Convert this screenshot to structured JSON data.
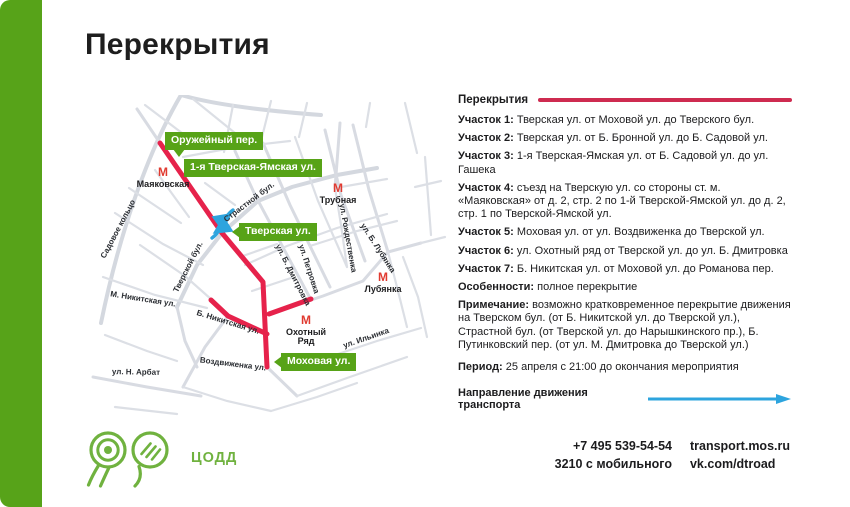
{
  "title": "Перекрытия",
  "colors": {
    "accent_green": "#57a319",
    "label_green": "#57a317",
    "closure_red": "#e6224b",
    "rule_red": "#ce2b50",
    "direction_blue": "#2da4de",
    "metro_red": "#e03a30",
    "logo_green": "#70b23f"
  },
  "map": {
    "metro_symbol": "М",
    "closure_labels": [
      "Оружейный пер.",
      "1-я Тверская-Ямская ул.",
      "Тверская ул.",
      "Моховая ул."
    ],
    "metro_stations": [
      "Маяковская",
      "Трубная",
      "Лубянка",
      "Охотный Ряд"
    ],
    "streets": [
      "Садовое кольцо",
      "М. Никитская ул.",
      "Б. Никитская ул.",
      "ул. Н. Арбат",
      "Воздвиженка ул.",
      "Тверской бул.",
      "Страстной бул.",
      "ул. Б. Дмитровка",
      "ул. Петровка",
      "ул. Рождественка",
      "ул. Б. Лубянка",
      "ул. Ильинка"
    ]
  },
  "panel": {
    "header": "Перекрытия",
    "sections": [
      {
        "label": "Участок 1:",
        "text": "Тверская ул. от Моховой ул. до Тверского бул."
      },
      {
        "label": "Участок 2:",
        "text": "Тверская ул. от Б. Бронной ул. до Б. Садовой ул."
      },
      {
        "label": "Участок 3:",
        "text": "1-я Тверская-Ямская ул. от Б. Садовой ул. до ул. Гашека"
      },
      {
        "label": "Участок 4:",
        "text": "съезд на Тверскую ул. со стороны ст. м. «Маяковская» от д. 2, стр. 2 по 1-й Тверской-Ямской ул. до д. 2, стр. 1 по Тверской-Ямской ул."
      },
      {
        "label": "Участок 5:",
        "text": "Моховая ул. от ул. Воздвиженка до Тверской ул."
      },
      {
        "label": "Участок 6:",
        "text": "ул. Охотный ряд от Тверской ул. до ул. Б. Дмитровка"
      },
      {
        "label": "Участок 7:",
        "text": "Б. Никитская ул. от Моховой ул. до Романова пер."
      }
    ],
    "features": {
      "label": "Особенности:",
      "text": "полное перекрытие"
    },
    "note": {
      "label": "Примечание:",
      "text": "возможно кратковременное перекрытие движения на Тверском бул. (от Б. Никитской ул. до Тверской ул.), Страстной бул. (от Тверской ул. до Нарышкинского пр.), Б. Путинковский пер. (от ул. М. Дмитровка до Тверской ул.)"
    },
    "period": {
      "label": "Период:",
      "text": "25 апреля с 21:00 до окончания мероприятия"
    },
    "direction": "Направление движения транспорта"
  },
  "footer": {
    "logo_text": "ЦОДД",
    "phone_main": "+7 495 539-54-54",
    "phone_mobile": "3210 с мобильного",
    "site": "transport.mos.ru",
    "social": "vk.com/dtroad"
  }
}
